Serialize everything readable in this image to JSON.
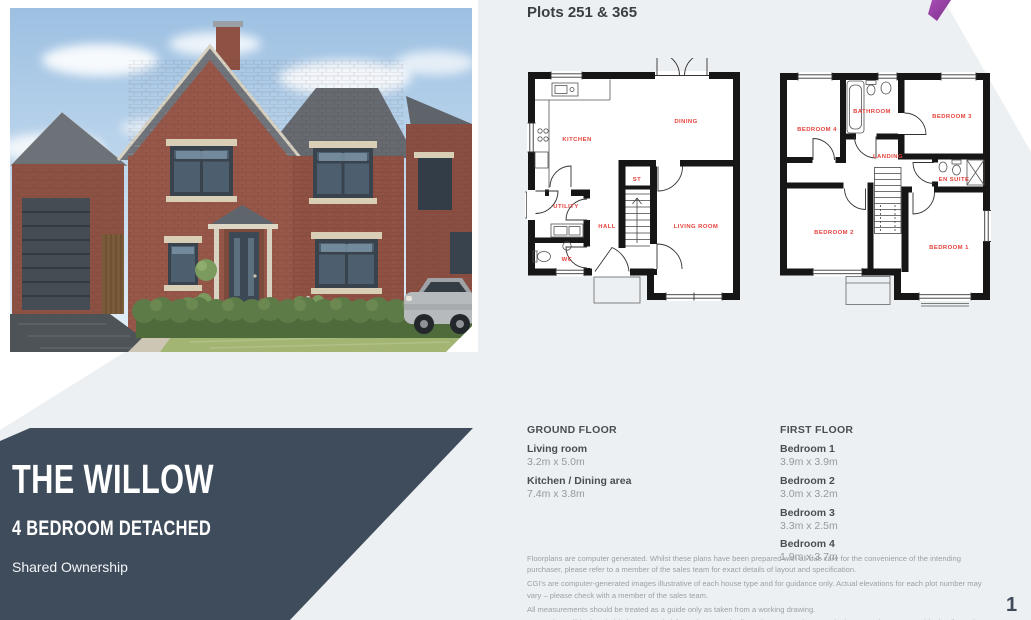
{
  "header": {
    "plots_title": "Plots 251 & 365"
  },
  "title_block": {
    "name": "THE WILLOW",
    "subtitle": "4 BEDROOM DETACHED",
    "tenure": "Shared Ownership"
  },
  "ground_floor": {
    "heading": "GROUND FLOOR",
    "rooms": [
      {
        "label": "Living room",
        "dims": "3.2m x 5.0m"
      },
      {
        "label": "Kitchen / Dining area",
        "dims": "7.4m x 3.8m"
      }
    ],
    "plan_labels": {
      "kitchen": "KITCHEN",
      "dining": "DINING",
      "st": "ST",
      "utility": "UTILITY",
      "hall": "HALL",
      "wc": "WC",
      "living_room": "LIVING ROOM"
    }
  },
  "first_floor": {
    "heading": "FIRST FLOOR",
    "rooms": [
      {
        "label": "Bedroom 1",
        "dims": "3.9m x 3.9m"
      },
      {
        "label": "Bedroom 2",
        "dims": "3.0m x 3.2m"
      },
      {
        "label": "Bedroom 3",
        "dims": "3.3m x 2.5m"
      },
      {
        "label": "Bedroom 4",
        "dims": "1.9m x 3.7m"
      }
    ],
    "plan_labels": {
      "bedroom4": "BEDROOM 4",
      "bathroom": "BATHROOM",
      "bedroom3": "BEDROOM 3",
      "landing": "LANDING",
      "ensuite": "EN SUITE",
      "bedroom2": "BEDROOM 2",
      "bedroom1": "BEDROOM 1"
    }
  },
  "disclaimer": {
    "lines": [
      "Floorplans are computer generated. Whilst these plans have been prepared with all due care for the convenience of the intending purchaser, please refer to a member of the sales team for exact details of layout and specification.",
      "CGI's are computer-generated images illustrative of each house type and for guidance only. Actual elevations for each plot number may vary – please check with a member of the sales team.",
      "All measurements should be treated as a guide only as taken from a working drawing.",
      "Some plots will be handed (mirror opposite) from shown on the floor plan. Your Sales & Marketing Consultant can provide details on those concerned."
    ]
  },
  "footer": {
    "page_number": "1"
  },
  "colors": {
    "slate": "#3f4c5c",
    "background_gray": "#edf0f2",
    "plan_label_red": "#e5413b",
    "accent_purple": "#9b3fae"
  }
}
